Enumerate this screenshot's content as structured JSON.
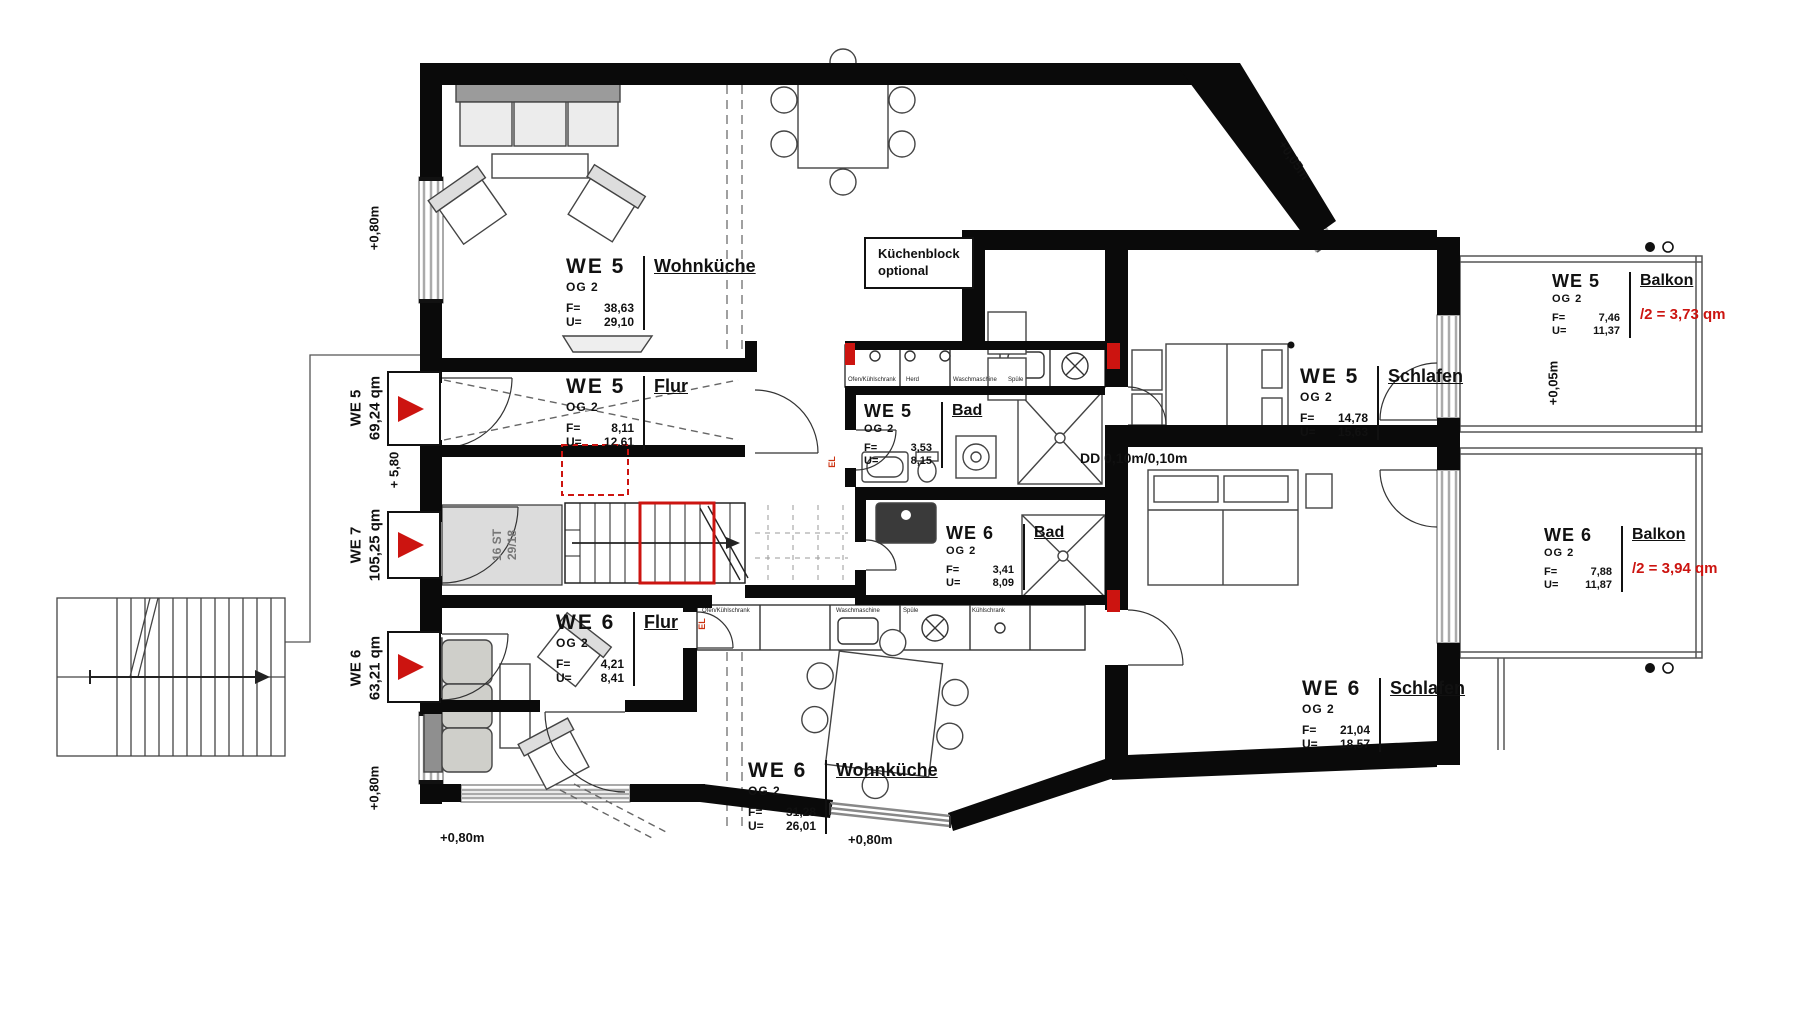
{
  "plan": {
    "rooms": {
      "we5_wohnkueche": {
        "we": "WE 5",
        "og": "OG 2",
        "name": "Wohnküche",
        "f_label": "F=",
        "u_label": "U=",
        "f": "38,63",
        "u": "29,10"
      },
      "we5_flur": {
        "we": "WE 5",
        "og": "OG 2",
        "name": "Flur",
        "f_label": "F=",
        "u_label": "U=",
        "f": "8,11",
        "u": "12,61"
      },
      "we5_bad": {
        "we": "WE 5",
        "og": "OG 2",
        "name": "Bad",
        "f_label": "F=",
        "u_label": "U=",
        "f": "3,53",
        "u": "8,15"
      },
      "we5_schlafen": {
        "we": "WE 5",
        "og": "OG 2",
        "name": "Schlafen",
        "f_label": "F=",
        "u_label": "U=",
        "f": "14,78",
        "u": "15,63"
      },
      "we5_balkon": {
        "we": "WE 5",
        "og": "OG 2",
        "name": "Balkon",
        "f_label": "F=",
        "u_label": "U=",
        "f": "7,46",
        "u": "11,37",
        "half": "/2 = 3,73 qm"
      },
      "we6_bad": {
        "we": "WE 6",
        "og": "OG 2",
        "name": "Bad",
        "f_label": "F=",
        "u_label": "U=",
        "f": "3,41",
        "u": "8,09"
      },
      "we6_flur": {
        "we": "WE 6",
        "og": "OG 2",
        "name": "Flur",
        "f_label": "F=",
        "u_label": "U=",
        "f": "4,21",
        "u": "8,41"
      },
      "we6_wohnkueche": {
        "we": "WE 6",
        "og": "OG 2",
        "name": "Wohnküche",
        "f_label": "F=",
        "u_label": "U=",
        "f": "31,28",
        "u": "26,01"
      },
      "we6_schlafen": {
        "we": "WE 6",
        "og": "OG 2",
        "name": "Schlafen",
        "f_label": "F=",
        "u_label": "U=",
        "f": "21,04",
        "u": "18,57"
      },
      "we6_balkon": {
        "we": "WE 6",
        "og": "OG 2",
        "name": "Balkon",
        "f_label": "F=",
        "u_label": "U=",
        "f": "7,88",
        "u": "11,87",
        "half": "/2 = 3,94 qm"
      }
    },
    "units": {
      "we5": {
        "we": "WE 5",
        "area": "69,24 qm"
      },
      "we7": {
        "we": "WE 7",
        "area": "105,25 qm"
      },
      "we6": {
        "we": "WE 6",
        "area": "63,21 qm"
      }
    },
    "annotations": {
      "kuechenblock_line1": "Küchenblock",
      "kuechenblock_line2": "optional",
      "dd": "DD 0,10m/0,10m",
      "stair_line1": "16 ST",
      "stair_line2": "29/18",
      "level_plus580": "+ 5,80",
      "el": "EL"
    },
    "elevations": {
      "top_left": "+0,80m",
      "bottom_left_v": "+0,80m",
      "bottom_left_h": "+0,80m",
      "bottom_mid": "+0,80m",
      "diag_top_right": "+0,05m",
      "balcony_right": "+0,05m"
    },
    "counter_labels": {
      "we5": [
        "Ofen/Kühlschrank",
        "Herd",
        "Waschmaschine",
        "Spüle"
      ],
      "we6": [
        "Ofen/Kühlschrank",
        "Waschmaschine",
        "Spüle",
        "Kühlschrank"
      ]
    },
    "colors": {
      "accent_red": "#cc1410",
      "wall_black": "#0a0a0a",
      "window_gray": "#aaaaaa"
    }
  }
}
